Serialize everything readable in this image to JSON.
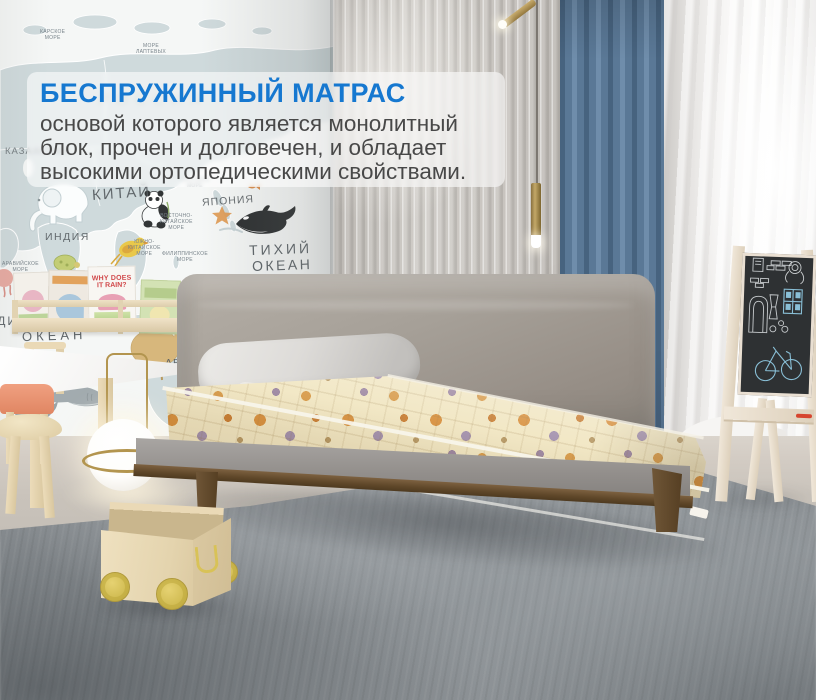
{
  "overlay": {
    "title": "БЕСПРУЖИННЫЙ МАТРАС",
    "body_lines": [
      "основой которого является монолитный",
      "блок, прочен и долговечен, и обладает",
      "высокими ортопедическими свойствами."
    ]
  },
  "map": {
    "labels": {
      "russia": "РОССИЯ",
      "kazakhstan": "КАЗАХСТАН",
      "china": "КИТАЙ",
      "japan": "ЯПОНИЯ",
      "india": "ИНДИЯ",
      "australia": "АВСТРАЛИЯ",
      "pacific_1": "ТИХИЙ",
      "pacific_2": "ОКЕАН",
      "indian_1": "ИНДИЙСКИЙ",
      "indian_2": "ОКЕАН",
      "kara_sea": "КАРСКОЕ\nМОРЕ",
      "laptev_sea": "МОРЕ\nЛАПТЕВЫХ",
      "okhotsk_sea": "ОХОТСКОЕ\nМОРЕ",
      "east_china_sea": "ВОСТОЧНО-\nКИТАЙСКОЕ\nМОРЕ",
      "south_china_sea": "ЮЖНО-\nКИТАЙСКОЕ\nМОРЕ",
      "philippine_sea": "ФИЛИППИНСКОЕ\nМОРЕ",
      "arabian_sea": "АРАВИЙСКОЕ\nМОРЕ"
    }
  },
  "bookshelf": {
    "book_title_line1": "WHY DOES",
    "book_title_line2": "IT RAIN?"
  },
  "colors": {
    "title_blue": "#1678d0",
    "curtain_blue": "#5d7b9a",
    "mattress_cream": "#f1e6c2",
    "pattern_orange": "#d8913f",
    "pattern_purple": "#9c86a0",
    "wood_walnut": "#6b5236",
    "birch_wood": "#e9dcc2",
    "coral_chair": "#e8967a",
    "brass": "#b3954f",
    "chalkboard": "#2e3133"
  }
}
